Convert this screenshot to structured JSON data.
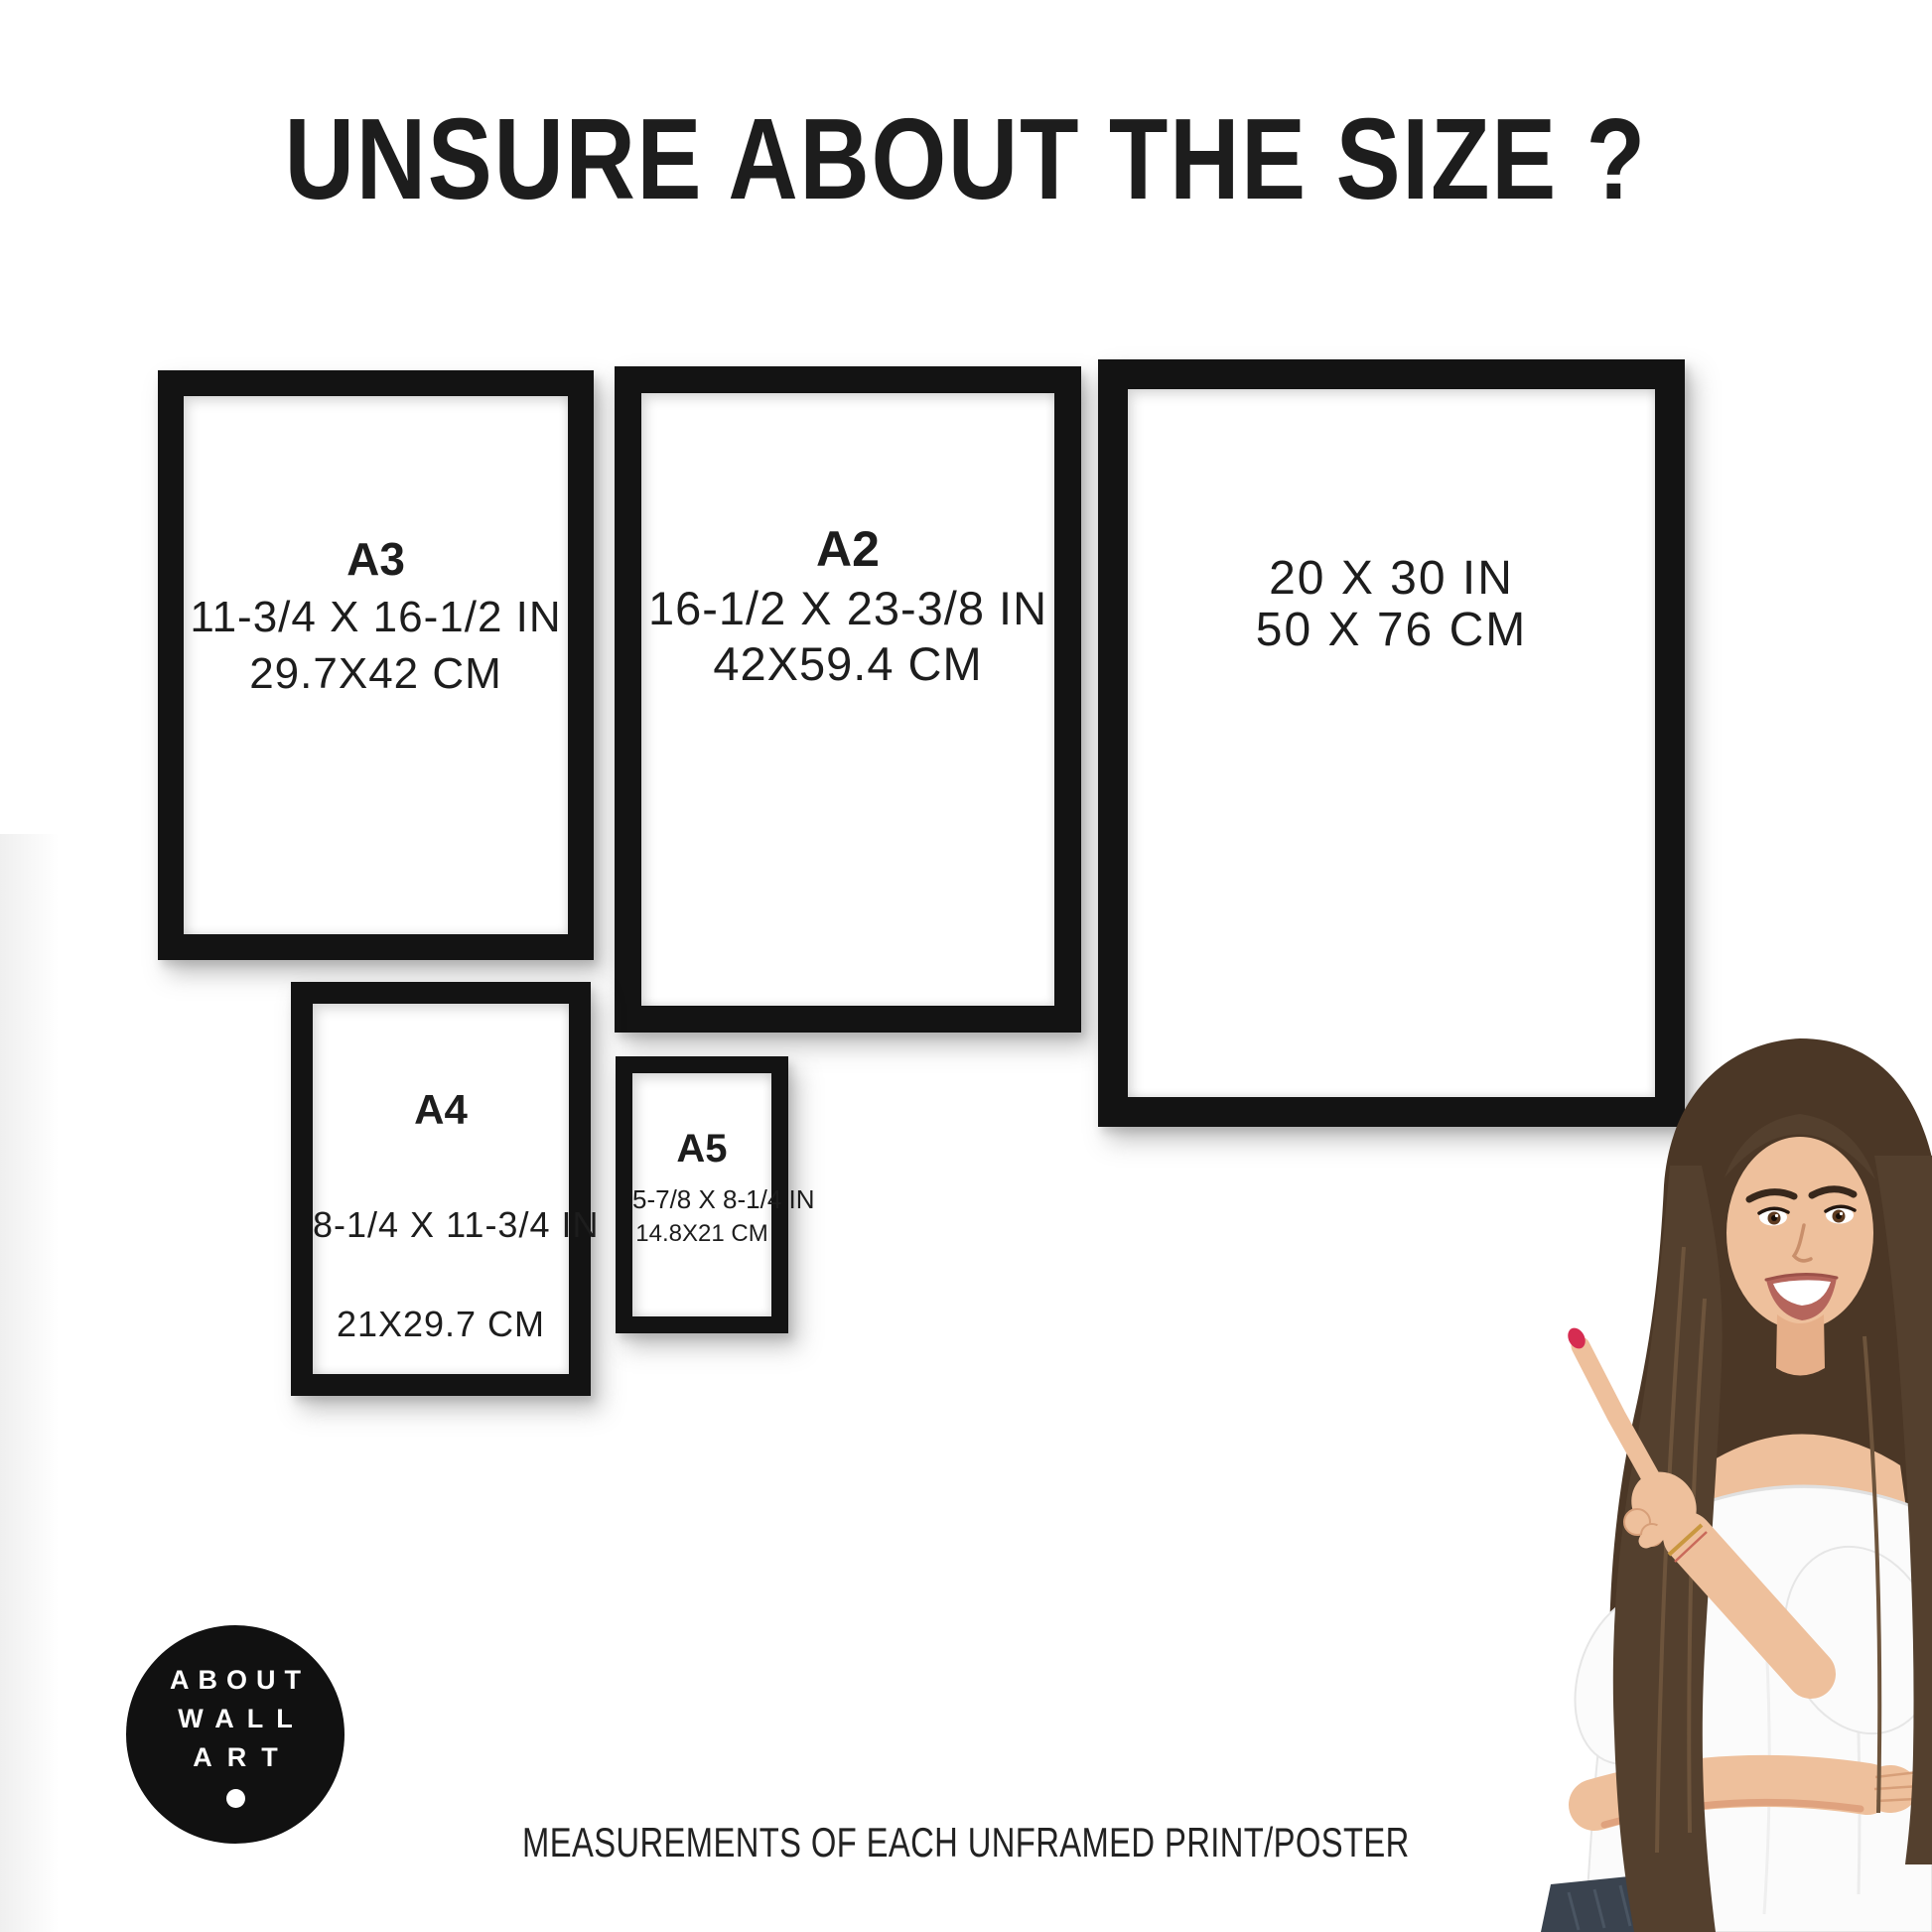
{
  "page": {
    "title": "UNSURE ABOUT THE SIZE ?",
    "footer": "MEASUREMENTS OF EACH UNFRAMED PRINT/POSTER"
  },
  "frames": [
    {
      "name": "A3",
      "label": "A3",
      "inches": "11-3/4 X 16-1/2 IN",
      "cm": "29.7X42 CM"
    },
    {
      "name": "A2",
      "label": "A2",
      "inches": "16-1/2 X 23-3/8 IN",
      "cm": "42X59.4 CM"
    },
    {
      "name": "20x30",
      "label": "",
      "inches": "20 X 30 IN",
      "cm": "50 X 76 CM"
    },
    {
      "name": "A4",
      "label": "A4",
      "inches": "8-1/4 X 11-3/4 IN",
      "cm": "21X29.7 CM"
    },
    {
      "name": "A5",
      "label": "A5",
      "inches": "5-7/8 X 8-1/4 IN",
      "cm": "14.8X21 CM"
    }
  ],
  "logo": {
    "line1": "ABOUT",
    "line2": "WALL",
    "line3": "ART"
  },
  "colors": {
    "frame_black": "#131313",
    "text": "#1d1d1d",
    "background": "#ffffff",
    "hair_brown": "#54402e",
    "skin": "#eec09c",
    "nail_red": "#d62c51",
    "jeans": "#3a434f",
    "blouse_white": "#fbfbfb"
  }
}
